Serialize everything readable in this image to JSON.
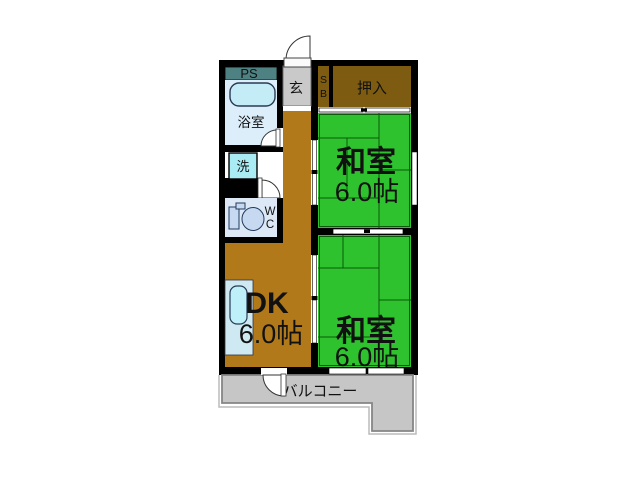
{
  "plan_title": "1DK+2 washitsu apartment floor plan",
  "rooms": {
    "washitsu1": {
      "name": "和室",
      "size": "6.0帖"
    },
    "washitsu2": {
      "name": "和室",
      "size": "6.0帖"
    },
    "dk": {
      "name": "DK",
      "size": "6.0帖"
    },
    "closet": {
      "label": "押入"
    },
    "shoe_box": {
      "top": "S",
      "bottom": "B"
    },
    "entrance": {
      "label": "玄"
    },
    "pipe_space": {
      "label": "PS"
    },
    "bathroom": {
      "label": "浴室"
    },
    "washer": {
      "label": "洗"
    },
    "wc": {
      "top": "W",
      "bottom": "C"
    },
    "balcony": {
      "label": "バルコニー"
    }
  },
  "colors": {
    "wall_black": "#000000",
    "tatami_green": "#2fc22f",
    "tatami_line": "#0a5a0a",
    "dk_brown": "#b1791a",
    "closet_brown": "#7d5c12",
    "entrance_gray": "#c9c9c9",
    "balcony_gray": "#c6c6c6",
    "balcony_edge": "#858585",
    "pipe_space_teal": "#4e8181",
    "bathroom_blue": "#ddeefb",
    "wc_blue": "#dce8f6",
    "tub_cyan": "#c3ecf7",
    "washer_cyan": "#a9ecf4",
    "kitchen_blue": "#cfe9f3",
    "sink_cyan": "#bdf0f8",
    "fixture_blue": "#c7d9f0",
    "balcony_text": "#6b6b6b"
  }
}
